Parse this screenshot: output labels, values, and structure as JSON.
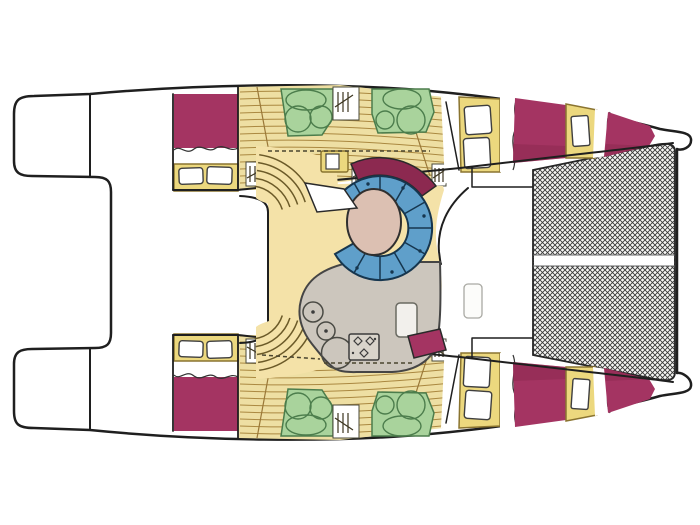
{
  "canvas": {
    "width": 700,
    "height": 525
  },
  "colors": {
    "background": "#ffffff",
    "outline": "#1f1f1f",
    "deck": "#ffffff",
    "bed": "#a43462",
    "bed_shade": "#8c2950",
    "wood": "#eedfa3",
    "plank_line": "#aa8840",
    "salon_floor": "#f4e2a8",
    "cabinet": "#ecd87e",
    "cabinet_line": "#8a7430",
    "pillow": "#ffffff",
    "seat_green": "#a9d39c",
    "seat_green_line": "#4c7d4c",
    "sofa_blue": "#5f9fca",
    "sofa_line": "#16364f",
    "table_tan": "#dcc0b2",
    "counter_gray": "#ccc6bd",
    "counter_line": "#454545",
    "net_bg": "#f7f7f5",
    "net_line": "#383838",
    "stair_line": "#6b5a28",
    "dash_line": "#4a452f"
  },
  "areas": [
    "swim-platform-port",
    "swim-platform-starboard",
    "aft-cockpit",
    "hull-starboard",
    "hull-port",
    "aft-cabin-berth",
    "forward-cabin-berths",
    "hull-corridor",
    "stairs",
    "salon",
    "curved-settee",
    "salon-table",
    "galley-counter",
    "sink",
    "stove",
    "dinette-seats",
    "companionway-hatch",
    "foredeck",
    "trampoline-net"
  ]
}
